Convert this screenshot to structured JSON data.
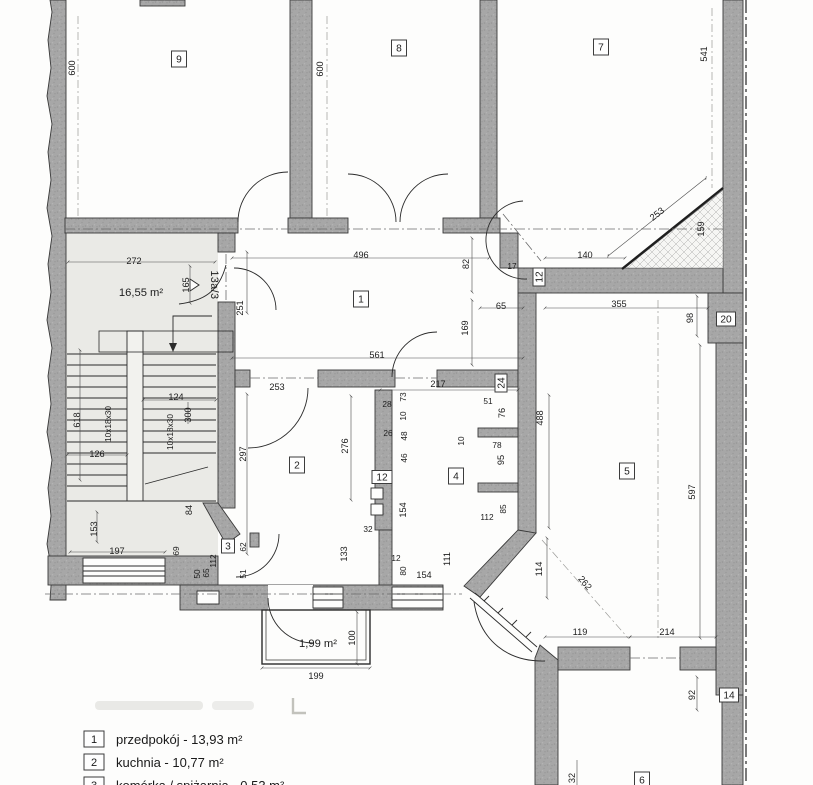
{
  "document": {
    "kind": "scanned floor plan"
  },
  "colors": {
    "wall": "#a7a7a7",
    "paper": "#fdfdfc",
    "stair_floor": "#eaeae6",
    "ink": "#1d1d1d"
  },
  "plan": {
    "unit_label": "13a/3",
    "dim_labels": [
      {
        "t": "600",
        "x": 72,
        "y": 68,
        "r": -90
      },
      {
        "t": "600",
        "x": 320,
        "y": 69,
        "r": -90
      },
      {
        "t": "541",
        "x": 704,
        "y": 54,
        "r": -90
      },
      {
        "t": "253",
        "x": 657,
        "y": 214,
        "r": -38
      },
      {
        "t": "159",
        "x": 701,
        "y": 229,
        "r": -90
      },
      {
        "t": "140",
        "x": 585,
        "y": 255
      },
      {
        "t": "272",
        "x": 134,
        "y": 261
      },
      {
        "t": "16,55 m²",
        "x": 141,
        "y": 293,
        "c": "area"
      },
      {
        "t": "165",
        "x": 186,
        "y": 285,
        "r": -90
      },
      {
        "t": "13a/3",
        "x": 214,
        "y": 285,
        "r": 90,
        "c": "unit"
      },
      {
        "t": "251",
        "x": 240,
        "y": 308,
        "r": -90
      },
      {
        "t": "496",
        "x": 361,
        "y": 255
      },
      {
        "t": "82",
        "x": 466,
        "y": 264,
        "r": -90
      },
      {
        "t": "17",
        "x": 512,
        "y": 266,
        "c": "small"
      },
      {
        "t": "65",
        "x": 501,
        "y": 306
      },
      {
        "t": "355",
        "x": 619,
        "y": 304
      },
      {
        "t": "98",
        "x": 690,
        "y": 318,
        "r": -90
      },
      {
        "t": "169",
        "x": 465,
        "y": 328,
        "r": -90
      },
      {
        "t": "561",
        "x": 377,
        "y": 355
      },
      {
        "t": "253",
        "x": 277,
        "y": 387
      },
      {
        "t": "217",
        "x": 438,
        "y": 384
      },
      {
        "t": "51",
        "x": 488,
        "y": 401,
        "c": "small"
      },
      {
        "t": "76",
        "x": 502,
        "y": 413,
        "r": -90
      },
      {
        "t": "28",
        "x": 387,
        "y": 404,
        "c": "small"
      },
      {
        "t": "73",
        "x": 403,
        "y": 397,
        "r": -90,
        "c": "small"
      },
      {
        "t": "10",
        "x": 403,
        "y": 416,
        "r": -90,
        "c": "small"
      },
      {
        "t": "26",
        "x": 388,
        "y": 433,
        "c": "small"
      },
      {
        "t": "48",
        "x": 404,
        "y": 436,
        "r": -90,
        "c": "small"
      },
      {
        "t": "46",
        "x": 404,
        "y": 458,
        "r": -90,
        "c": "small"
      },
      {
        "t": "10",
        "x": 461,
        "y": 441,
        "r": -90,
        "c": "small"
      },
      {
        "t": "78",
        "x": 497,
        "y": 445,
        "c": "small"
      },
      {
        "t": "95",
        "x": 501,
        "y": 460,
        "r": -90
      },
      {
        "t": "297",
        "x": 243,
        "y": 454,
        "r": -90
      },
      {
        "t": "276",
        "x": 345,
        "y": 446,
        "r": -90
      },
      {
        "t": "488",
        "x": 540,
        "y": 418,
        "r": -90
      },
      {
        "t": "597",
        "x": 692,
        "y": 492,
        "r": -90
      },
      {
        "t": "85",
        "x": 503,
        "y": 509,
        "r": -90,
        "c": "small"
      },
      {
        "t": "112",
        "x": 487,
        "y": 517,
        "c": "small"
      },
      {
        "t": "154",
        "x": 403,
        "y": 510,
        "r": -90
      },
      {
        "t": "32",
        "x": 368,
        "y": 529,
        "c": "small"
      },
      {
        "t": "133",
        "x": 344,
        "y": 554,
        "r": -90
      },
      {
        "t": "62",
        "x": 243,
        "y": 547,
        "r": -90,
        "c": "small"
      },
      {
        "t": "112",
        "x": 213,
        "y": 561,
        "r": -90,
        "c": "small"
      },
      {
        "t": "65",
        "x": 206,
        "y": 573,
        "r": -90,
        "c": "small"
      },
      {
        "t": "50",
        "x": 197,
        "y": 574,
        "r": -90,
        "c": "small"
      },
      {
        "t": "51",
        "x": 243,
        "y": 574,
        "r": -90,
        "c": "small"
      },
      {
        "t": "69",
        "x": 176,
        "y": 551,
        "r": -90,
        "c": "small"
      },
      {
        "t": "618",
        "x": 77,
        "y": 420,
        "r": -90
      },
      {
        "t": "10x18x30",
        "x": 108,
        "y": 424,
        "r": -90,
        "c": "small"
      },
      {
        "t": "10x18x30",
        "x": 170,
        "y": 432,
        "r": -90,
        "c": "small"
      },
      {
        "t": "124",
        "x": 176,
        "y": 397
      },
      {
        "t": "300",
        "x": 188,
        "y": 415,
        "r": -90
      },
      {
        "t": "126",
        "x": 97,
        "y": 454
      },
      {
        "t": "84",
        "x": 189,
        "y": 510,
        "r": -90
      },
      {
        "t": "153",
        "x": 94,
        "y": 529,
        "r": -90
      },
      {
        "t": "197",
        "x": 117,
        "y": 551
      },
      {
        "t": "12",
        "x": 396,
        "y": 558,
        "c": "small"
      },
      {
        "t": "80",
        "x": 403,
        "y": 571,
        "r": -90,
        "c": "small"
      },
      {
        "t": "154",
        "x": 424,
        "y": 575
      },
      {
        "t": "111",
        "x": 447,
        "y": 559,
        "r": -90
      },
      {
        "t": "114",
        "x": 539,
        "y": 569,
        "r": -90
      },
      {
        "t": "262",
        "x": 585,
        "y": 583,
        "r": 49
      },
      {
        "t": "119",
        "x": 580,
        "y": 632
      },
      {
        "t": "214",
        "x": 667,
        "y": 632
      },
      {
        "t": "1,99 m²",
        "x": 318,
        "y": 644,
        "c": "area"
      },
      {
        "t": "100",
        "x": 352,
        "y": 638,
        "r": -90
      },
      {
        "t": "199",
        "x": 316,
        "y": 676
      },
      {
        "t": "92",
        "x": 692,
        "y": 695,
        "r": -90
      },
      {
        "t": "32",
        "x": 572,
        "y": 778,
        "r": -90
      }
    ],
    "room_markers": [
      {
        "t": "9",
        "x": 179,
        "y": 59
      },
      {
        "t": "8",
        "x": 399,
        "y": 48
      },
      {
        "t": "7",
        "x": 601,
        "y": 47
      },
      {
        "t": "1",
        "x": 361,
        "y": 299
      },
      {
        "t": "2",
        "x": 297,
        "y": 465
      },
      {
        "t": "3",
        "x": 228,
        "y": 546,
        "w": 13,
        "h": 14
      },
      {
        "t": "4",
        "x": 456,
        "y": 476
      },
      {
        "t": "5",
        "x": 627,
        "y": 471
      },
      {
        "t": "6",
        "x": 642,
        "y": 780
      },
      {
        "t": "20",
        "x": 726,
        "y": 319,
        "w": 19,
        "h": 14
      },
      {
        "t": "14",
        "x": 729,
        "y": 695,
        "w": 19,
        "h": 14
      },
      {
        "t": "24",
        "x": 501,
        "y": 383,
        "w": 12,
        "h": 18,
        "r": -90
      },
      {
        "t": "12",
        "x": 539,
        "y": 277,
        "w": 12,
        "h": 18,
        "r": -90
      },
      {
        "t": "12",
        "x": 382,
        "y": 477,
        "w": 20,
        "h": 13
      }
    ]
  },
  "legend": {
    "items": [
      {
        "marker": "1",
        "text": "przedpokój - 13,93 m²"
      },
      {
        "marker": "2",
        "text": "kuchnia - 10,77 m²"
      },
      {
        "marker": "3",
        "text": "komórka / spiżarnia - 0,53 m²"
      }
    ]
  }
}
